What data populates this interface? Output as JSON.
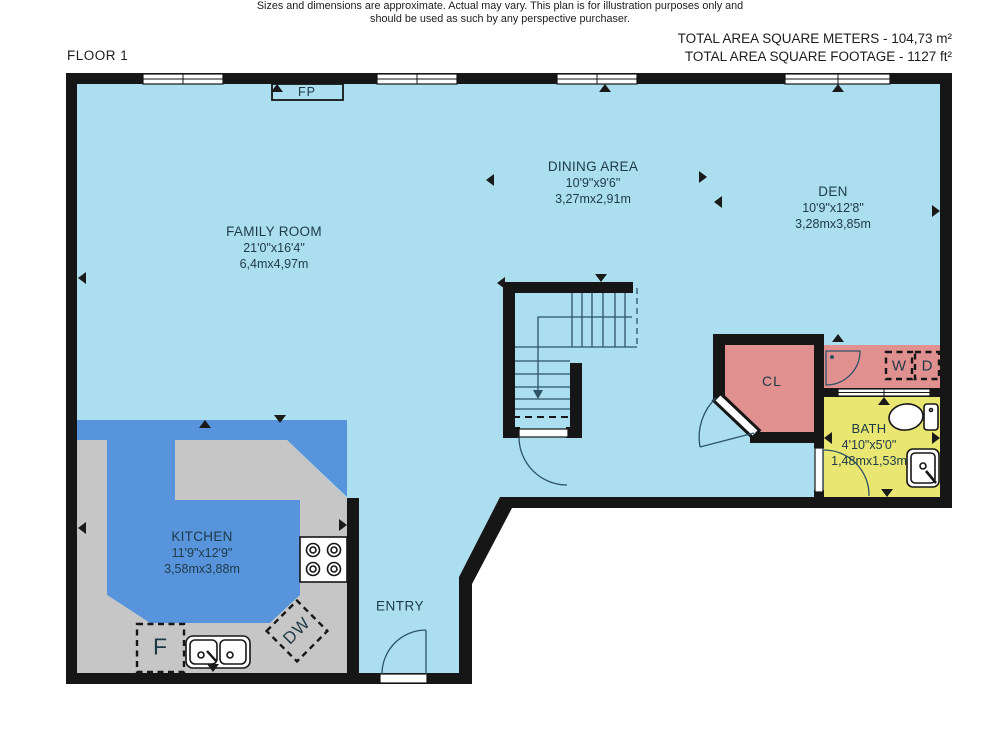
{
  "header": {
    "floor_label": "FLOOR 1",
    "total_area_metric": "TOTAL AREA SQUARE METERS - 104,73 m²",
    "total_area_imperial": "TOTAL AREA SQUARE FOOTAGE  - 1127 ft²"
  },
  "rooms": {
    "family_room": {
      "name": "FAMILY ROOM",
      "imperial": "21'0\"x16'4\"",
      "metric": "6,4mx4,97m"
    },
    "dining_area": {
      "name": "DINING AREA",
      "imperial": "10'9\"x9'6\"",
      "metric": "3,27mx2,91m"
    },
    "den": {
      "name": "DEN",
      "imperial": "10'9\"x12'8\"",
      "metric": "3,28mx3,85m"
    },
    "kitchen": {
      "name": "KITCHEN",
      "imperial": "11'9\"x12'9\"",
      "metric": "3,58mx3,88m"
    },
    "bath": {
      "name": "BATH",
      "imperial": "4'10\"x5'0\"",
      "metric": "1,48mx1,53m"
    },
    "entry": {
      "name": "ENTRY"
    },
    "closet": {
      "name": "CL"
    }
  },
  "fixtures": {
    "fireplace": "FP",
    "washer": "W",
    "dryer": "D",
    "fridge": "F",
    "dishwasher": "DW"
  },
  "footer": {
    "line1": "Sizes and dimensions are approximate. Actual may vary. This plan is for illustration purposes only and",
    "line2": "should be used as such by any perspective purchaser."
  },
  "colors": {
    "floor": "#abdff0",
    "kitchen-floor": "#5794db",
    "counter": "#c6c6c6",
    "closet-pink": "#e19090",
    "bath-yellow": "#e9e772",
    "wall": "#161616",
    "plan-line": "#2e5266",
    "label-ink": "#1e3a46",
    "text-ink": "#1d1d1d"
  }
}
